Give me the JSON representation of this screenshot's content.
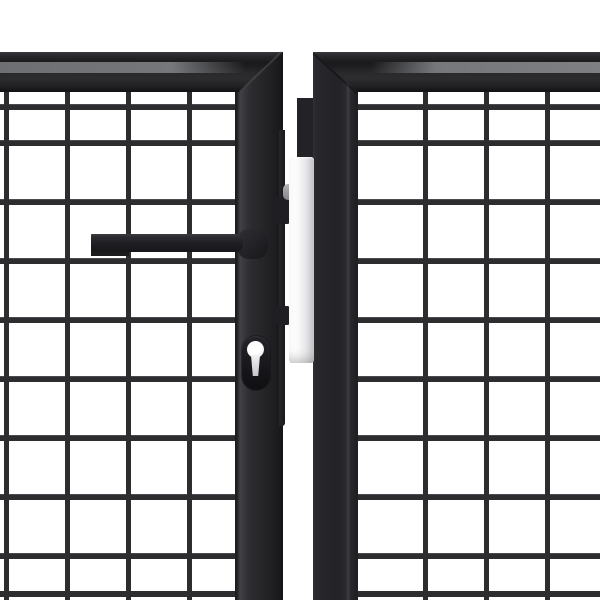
{
  "image": {
    "type": "product-photo",
    "alt": "Anthracite steel double garden gate with welded wire mesh infill, horizontal lever handle and euro cylinder keyhole, photographed on a white background",
    "text_content": "none"
  },
  "palette": {
    "bg": "#ffffff",
    "wire": "#2d2d30",
    "wireHi": "#4a4a50",
    "frame": "#26262a",
    "frameHighlight": "#3e3e43",
    "railStripe": "#76777a",
    "handle": "#17171a",
    "plateLight": "#ffffff",
    "plateDark": "#c5c5c8",
    "hardwareGray": "#b4b4b7",
    "keyholeWhite": "#ffffff"
  },
  "parts": {
    "stage": "Product photo of an anthracite mesh double garden gate",
    "left_panel_mesh": "Left gate panel welded wire mesh",
    "right_panel_mesh": "Right gate panel welded wire mesh",
    "left_rail": "Left panel top rail",
    "right_rail": "Right panel top rail",
    "left_rail_stripe": "Left top rail highlight face",
    "right_rail_stripe": "Right top rail highlight face",
    "left_miter": "Left panel mitered corner seam",
    "right_miter": "Right panel mitered corner seam",
    "left_stile": "Left panel meeting stile",
    "right_stile": "Right panel meeting stile",
    "bottom_wire_left": "Lower double wire, left panel",
    "bottom_wire_right": "Lower double wire, right panel",
    "strike_mount": "Strike mount block on right stile",
    "lock_case": "Lock case edge on left stile",
    "tab_upper": "Upper latch tab",
    "tab_lower": "Lower latch tab",
    "roller_guide": "Gray roller guide fitting",
    "strike_plate": "Galvanized strike plate in gate gap",
    "handle_boss": "Handle mounting boss",
    "handle_bar": "Square lever handle bar",
    "handle_step": "Lever handle lower step",
    "escutcheon": "Cylinder lock escutcheon",
    "keyhole_circle": "Euro cylinder keyhole, circular part",
    "keyhole_stem": "Euro cylinder keyhole, slot part"
  }
}
